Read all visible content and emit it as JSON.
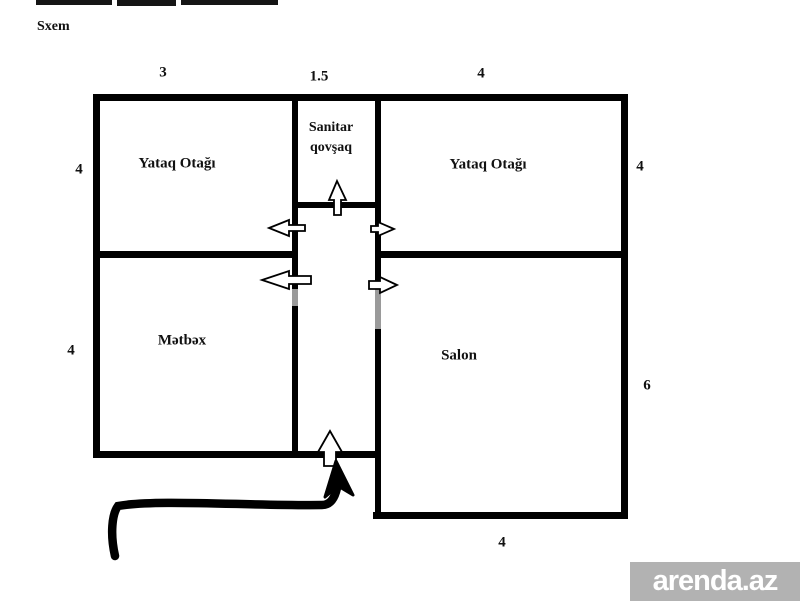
{
  "title": "Sxem",
  "rooms": {
    "bedroom_left": {
      "label": "Yataq Otağı"
    },
    "sanitary": {
      "label": "Sanitar qovşaq",
      "line1": "Sanitar",
      "line2": "qovşaq"
    },
    "bedroom_right": {
      "label": "Yataq Otağı"
    },
    "kitchen": {
      "label": "Mətbəx"
    },
    "salon": {
      "label": "Salon"
    }
  },
  "dimensions": {
    "top_left": "3",
    "top_middle": "1.5",
    "top_right": "4",
    "left_upper": "4",
    "right_upper": "4",
    "left_lower": "4",
    "right_lower": "6",
    "bottom": "4"
  },
  "watermark": {
    "text": "arenda.az",
    "bar_color": "#b2b2b2",
    "text_color": "#ffffff"
  },
  "colors": {
    "wall": "#000000",
    "background": "#ffffff",
    "wall_faded_segment": "#9a9a9a"
  },
  "icons": {
    "door_arrows": [
      "up-arrow-icon",
      "up-arrow-icon",
      "left-arrow-icon",
      "left-arrow-icon",
      "right-arrow-icon",
      "right-arrow-icon"
    ],
    "entrance": "hand-drawn-arrow-icon"
  }
}
